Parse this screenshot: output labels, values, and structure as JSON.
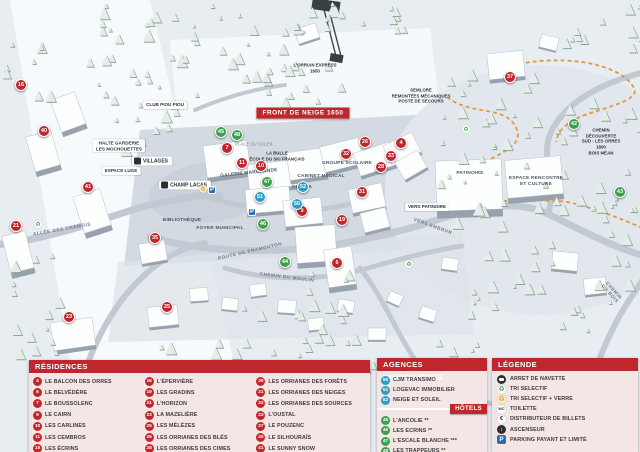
{
  "colors": {
    "red": "#bf272d",
    "green": "#3aa04a",
    "blue": "#2d9ec4",
    "accent_orange": "#e09a3e"
  },
  "map": {
    "markers": [
      {
        "n": "16",
        "c": "red",
        "x": 21,
        "y": 85
      },
      {
        "n": "40",
        "c": "red",
        "x": 44,
        "y": 131
      },
      {
        "n": "41",
        "c": "red",
        "x": 88,
        "y": 187
      },
      {
        "n": "21",
        "c": "red",
        "x": 16,
        "y": 226
      },
      {
        "n": "23",
        "c": "red",
        "x": 69,
        "y": 317
      },
      {
        "n": "25",
        "c": "red",
        "x": 167,
        "y": 307
      },
      {
        "n": "35",
        "c": "red",
        "x": 155,
        "y": 238
      },
      {
        "n": "7",
        "c": "red",
        "x": 227,
        "y": 148
      },
      {
        "n": "11",
        "c": "red",
        "x": 242,
        "y": 163
      },
      {
        "n": "10",
        "c": "red",
        "x": 261,
        "y": 166
      },
      {
        "n": "9",
        "c": "red",
        "x": 302,
        "y": 211
      },
      {
        "n": "19",
        "c": "red",
        "x": 342,
        "y": 220
      },
      {
        "n": "31",
        "c": "red",
        "x": 362,
        "y": 192
      },
      {
        "n": "26",
        "c": "red",
        "x": 365,
        "y": 142
      },
      {
        "n": "32",
        "c": "red",
        "x": 346,
        "y": 154
      },
      {
        "n": "28",
        "c": "red",
        "x": 381,
        "y": 167
      },
      {
        "n": "33",
        "c": "red",
        "x": 391,
        "y": 156
      },
      {
        "n": "4",
        "c": "red",
        "x": 401,
        "y": 143
      },
      {
        "n": "6",
        "c": "red",
        "x": 337,
        "y": 263
      },
      {
        "n": "37",
        "c": "red",
        "x": 510,
        "y": 77
      },
      {
        "n": "45",
        "c": "green",
        "x": 221,
        "y": 132
      },
      {
        "n": "48",
        "c": "green",
        "x": 237,
        "y": 135
      },
      {
        "n": "47",
        "c": "green",
        "x": 267,
        "y": 182
      },
      {
        "n": "46",
        "c": "green",
        "x": 263,
        "y": 224
      },
      {
        "n": "44",
        "c": "green",
        "x": 285,
        "y": 262
      },
      {
        "n": "42",
        "c": "green",
        "x": 574,
        "y": 124
      },
      {
        "n": "43",
        "c": "green",
        "x": 620,
        "y": 192
      },
      {
        "n": "51",
        "c": "blue",
        "x": 260,
        "y": 197
      },
      {
        "n": "52",
        "c": "blue",
        "x": 303,
        "y": 187
      },
      {
        "n": "50",
        "c": "blue",
        "x": 297,
        "y": 204
      }
    ],
    "labels": [
      {
        "t": "FRONT DE NEIGE 1650",
        "x": 303,
        "y": 113,
        "r": 0,
        "s": "banner"
      },
      {
        "t": "L'ORRIAN EXPRESS\n1650",
        "x": 315,
        "y": 68,
        "r": 0,
        "s": "dark"
      },
      {
        "t": "VILLAGES",
        "x": 152,
        "y": 161,
        "r": 0,
        "s": "pill-lift"
      },
      {
        "t": "CHAMP LACAS",
        "x": 185,
        "y": 185,
        "r": 0,
        "s": "pill-lift"
      },
      {
        "t": "ALLÉE DES CHAMOIS",
        "x": 62,
        "y": 229,
        "r": -10,
        "s": "road"
      },
      {
        "t": "ROUTE DE PRAMOUTON",
        "x": 250,
        "y": 251,
        "r": -13,
        "s": "road"
      },
      {
        "t": "CHEMIN DU MOULIN",
        "x": 287,
        "y": 277,
        "r": 7,
        "s": "road"
      },
      {
        "t": "VERS EMBRUN",
        "x": 433,
        "y": 226,
        "r": 20,
        "s": "road"
      },
      {
        "t": "CHEMIN DU BOIS",
        "x": 612,
        "y": 292,
        "r": 48,
        "s": "road"
      },
      {
        "t": "PATINOIRE",
        "x": 470,
        "y": 174,
        "r": 0,
        "s": "bldg"
      },
      {
        "t": "VERS PATINOIRE",
        "x": 427,
        "y": 207,
        "r": 0,
        "s": "pill"
      },
      {
        "t": "ESPACE RENCONTRE\nET CULTURE",
        "x": 536,
        "y": 182,
        "r": 0,
        "s": "bldg"
      },
      {
        "t": "SEMLORE\nREMONTÉES MÉCANIQUES\nPOSTE DE SECOURS",
        "x": 421,
        "y": 96,
        "r": 0,
        "s": "dark"
      },
      {
        "t": "CLUB PIOU PIOU",
        "x": 165,
        "y": 105,
        "r": 0,
        "s": "pill"
      },
      {
        "t": "HALTE GARDERIE\nLES MOCHOUETTES",
        "x": 119,
        "y": 146,
        "r": 0,
        "s": "pill"
      },
      {
        "t": "ESPACE LUGE",
        "x": 121,
        "y": 171,
        "r": 0,
        "s": "pill"
      },
      {
        "t": "BIBLIOTHÈQUE",
        "x": 182,
        "y": 221,
        "r": 0,
        "s": "bldg"
      },
      {
        "t": "FOYER MUNICIPAL",
        "x": 220,
        "y": 229,
        "r": 0,
        "s": "bldg"
      },
      {
        "t": "GALERIE MARCHANDE",
        "x": 249,
        "y": 174,
        "r": -6,
        "s": "bldg"
      },
      {
        "t": "CABINET MÉDICAL",
        "x": 321,
        "y": 177,
        "r": 0,
        "s": "bldg"
      },
      {
        "t": "CINÉMA",
        "x": 302,
        "y": 188,
        "r": 0,
        "s": "bldg"
      },
      {
        "t": "LA BULLE\nÉCOLE DU SKI FRANÇAIS",
        "x": 277,
        "y": 156,
        "r": 0,
        "s": "dark"
      },
      {
        "t": "PLACE DU SOLEIL",
        "x": 254,
        "y": 144,
        "r": 0,
        "s": "place"
      },
      {
        "t": "GROUPE SCOLAIRE",
        "x": 347,
        "y": 164,
        "r": 0,
        "s": "bldg"
      },
      {
        "t": "CHEMIN DÉCOUVERTE\nSUD : LES ORRES 1800\nBOIS MÉAN",
        "x": 601,
        "y": 142,
        "r": 0,
        "s": "dark"
      }
    ],
    "icons": [
      {
        "type": "parking",
        "x": 212,
        "y": 190
      },
      {
        "type": "parking",
        "x": 252,
        "y": 212
      },
      {
        "type": "recycle",
        "x": 38,
        "y": 224
      },
      {
        "type": "recycle-y",
        "x": 203,
        "y": 189
      },
      {
        "type": "recycle",
        "x": 409,
        "y": 264
      },
      {
        "type": "recycle",
        "x": 466,
        "y": 129
      }
    ]
  },
  "panels": {
    "residences": {
      "title": "RÉSIDENCES",
      "cols": [
        [
          {
            "n": "4",
            "label": "LE BALCON DES ORRES"
          },
          {
            "n": "6",
            "label": "LE BELVÉDÈRE"
          },
          {
            "n": "7",
            "label": "LE BOUSSOLENC"
          },
          {
            "n": "9",
            "label": "LE CAIRN"
          },
          {
            "n": "10",
            "label": "LES CARLINES"
          },
          {
            "n": "11",
            "label": "LES CEMBROS"
          },
          {
            "n": "15",
            "label": "LES ÉCRINS"
          }
        ],
        [
          {
            "n": "16",
            "label": "L'ÉPERVIÈRE"
          },
          {
            "n": "19",
            "label": "LES GRADINS"
          },
          {
            "n": "21",
            "label": "L'HORIZON"
          },
          {
            "n": "23",
            "label": "LA MAZELIÈRE"
          },
          {
            "n": "25",
            "label": "LES MÉLÈZES"
          },
          {
            "n": "26",
            "label": "LES ORRIANES DES BLÉS"
          },
          {
            "n": "28",
            "label": "LES ORRIANES DES CIMES"
          }
        ],
        [
          {
            "n": "30",
            "label": "LES ORRIANES DES FORÊTS"
          },
          {
            "n": "31",
            "label": "LES ORRIANES DES NEIGES"
          },
          {
            "n": "32",
            "label": "LES ORRIANES DES SOURCES"
          },
          {
            "n": "33",
            "label": "L'OUSTAL"
          },
          {
            "n": "37",
            "label": "LE POUZENC"
          },
          {
            "n": "40",
            "label": "LE SILHOURAÏS"
          },
          {
            "n": "41",
            "label": "LE SUNNY SNOW"
          }
        ]
      ]
    },
    "agences": {
      "title": "AGENCES IMMOBILIÈRES",
      "items": [
        {
          "n": "50",
          "label": "CJM TRANSIMO"
        },
        {
          "n": "51",
          "label": "LOGEVAC IMMOBILIER"
        },
        {
          "n": "52",
          "label": "NEIGE ET SOLEIL"
        }
      ]
    },
    "hotels": {
      "title": "HÔTELS",
      "items": [
        {
          "n": "45",
          "label": "L'ANCOLIE **"
        },
        {
          "n": "46",
          "label": "LES ECRINS **"
        },
        {
          "n": "47",
          "label": "L'ESCALE BLANCHE ***"
        },
        {
          "n": "48",
          "label": "LES TRAPPEURS **"
        }
      ]
    },
    "legende": {
      "title": "LÉGENDE",
      "items": [
        {
          "icon": "bus",
          "label": "ARRET DE NAVETTE"
        },
        {
          "icon": "recycle-green",
          "label": "TRI SELECTIF"
        },
        {
          "icon": "recycle-yellow",
          "label": "TRI SELECTIF + VERRE"
        },
        {
          "icon": "wc",
          "label": "TOILETTE"
        },
        {
          "icon": "euro",
          "label": "DISTRIBUTEUR DE BILLETS"
        },
        {
          "icon": "elevator",
          "label": "ASCENSEUR"
        },
        {
          "icon": "parking",
          "label": "PARKING PAYANT ET LIMITÉ"
        }
      ]
    }
  }
}
